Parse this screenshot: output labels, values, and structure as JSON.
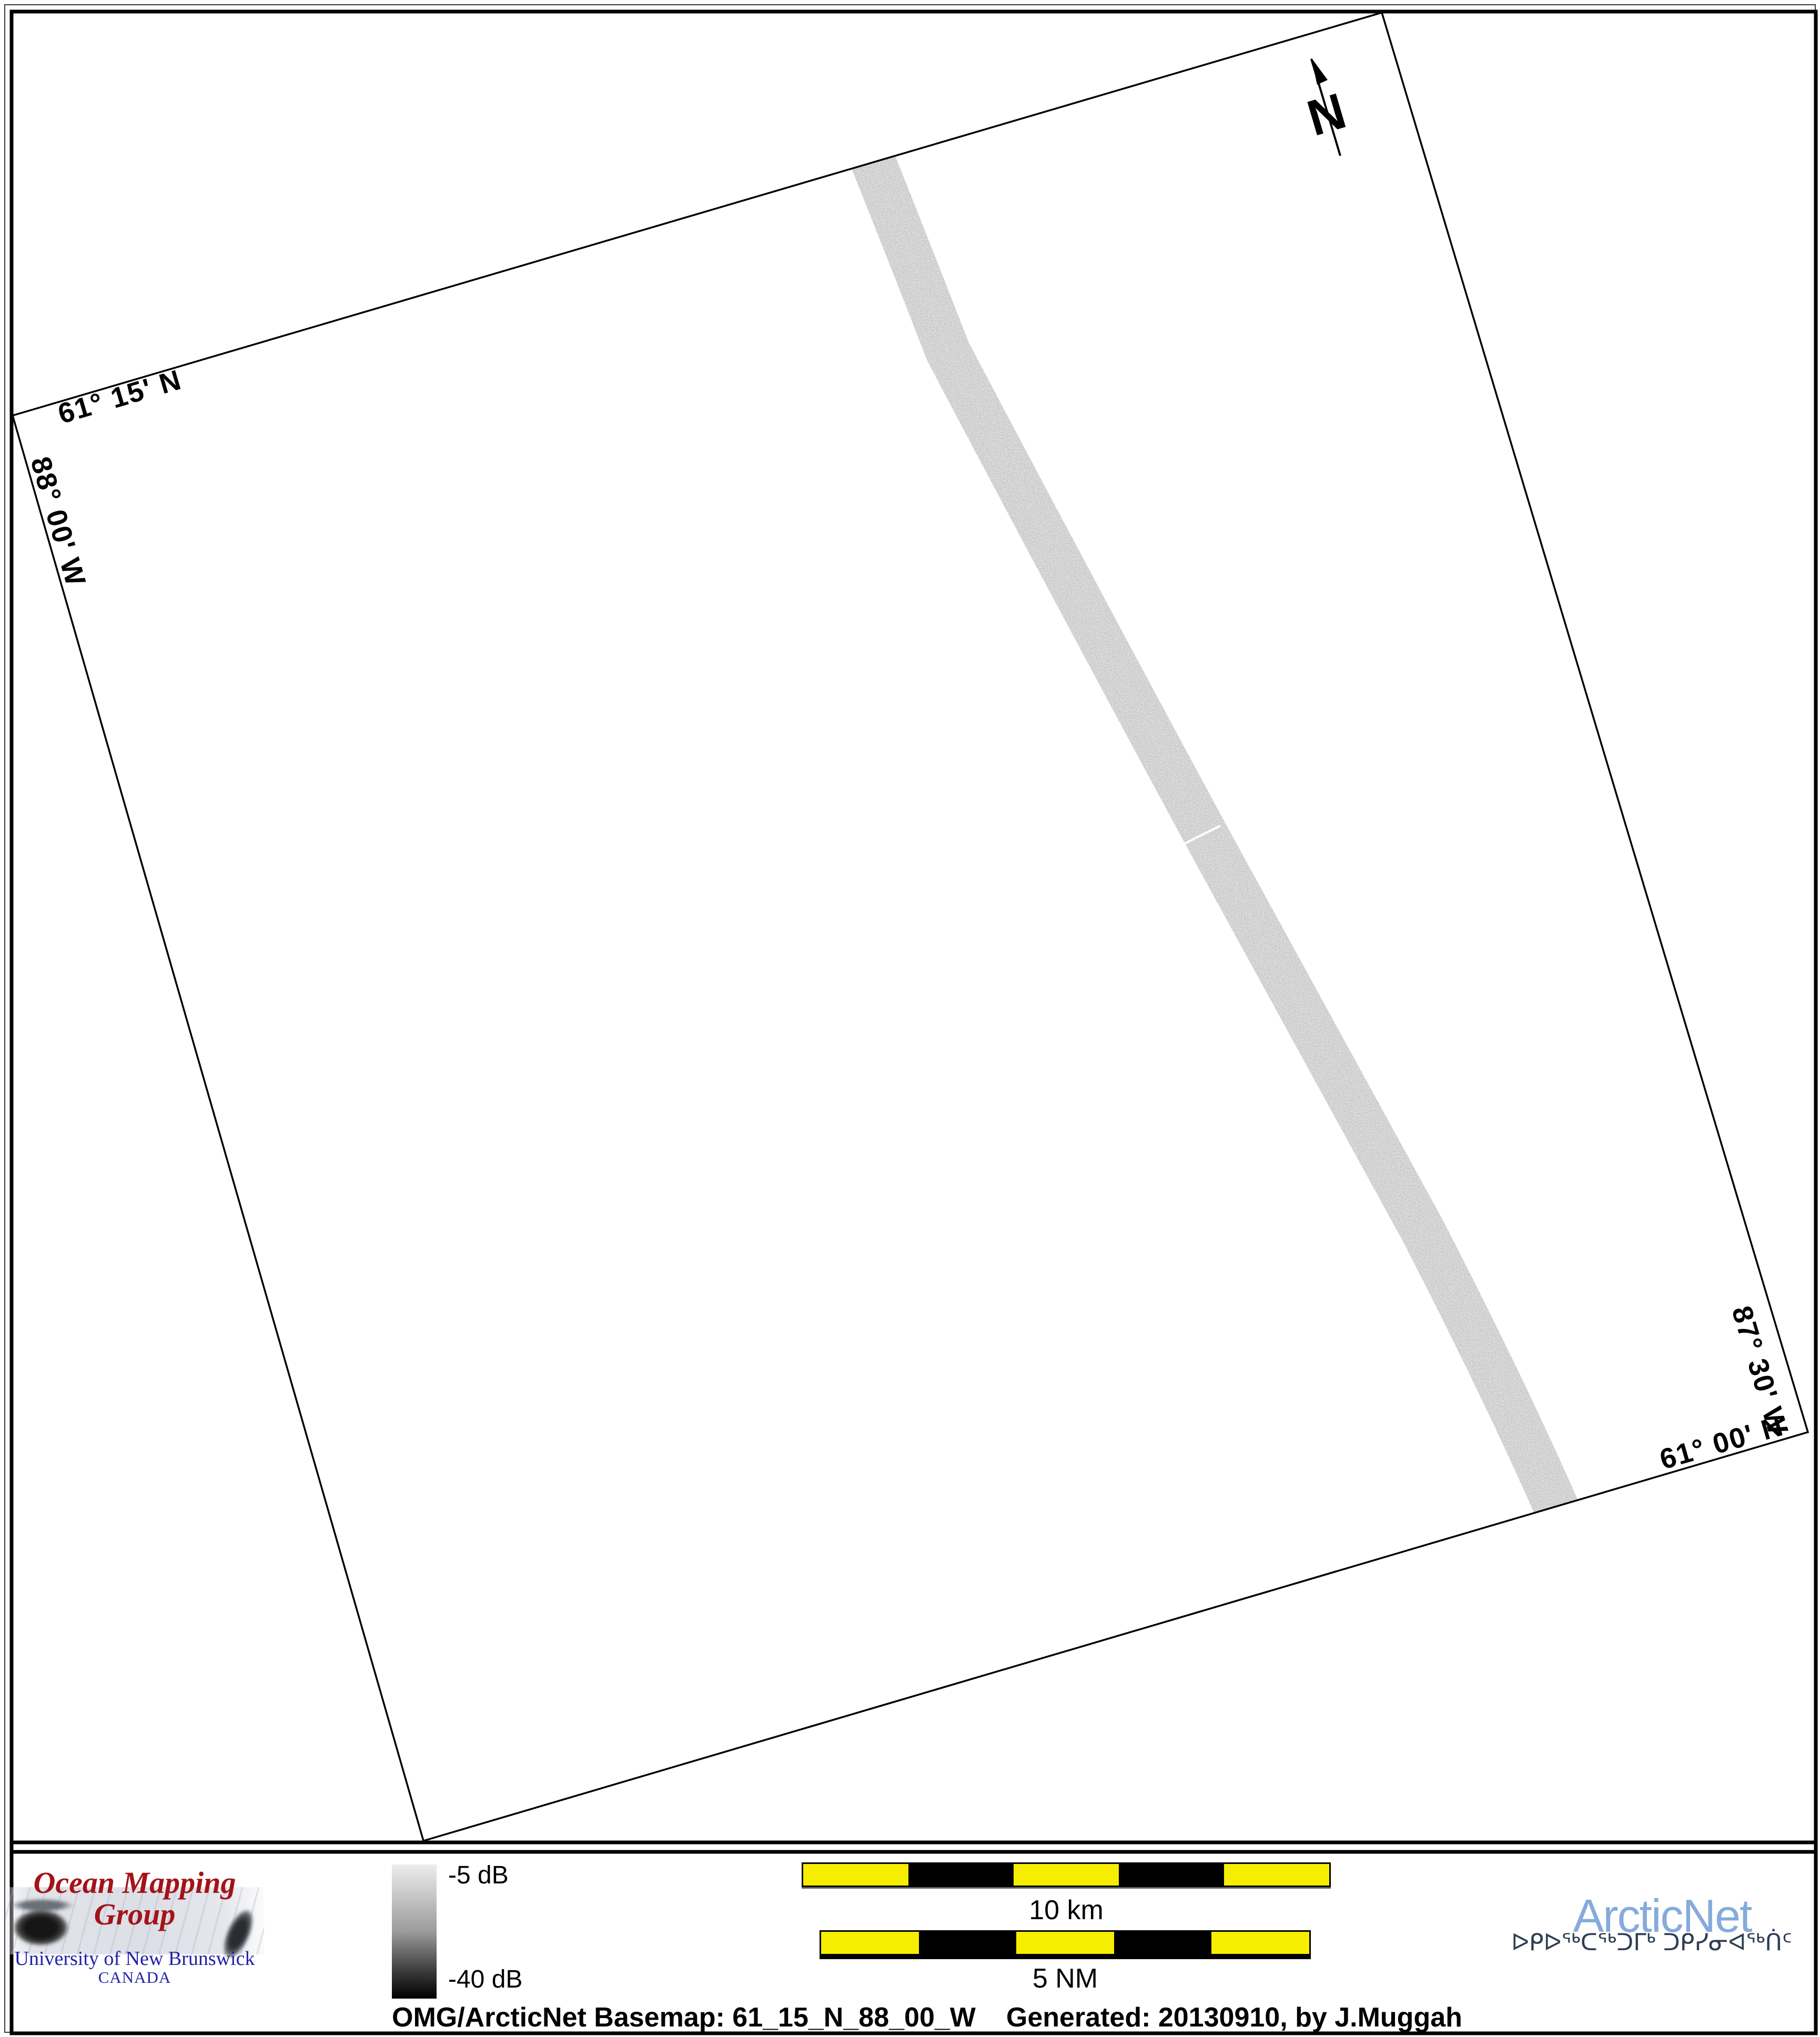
{
  "map": {
    "corner_labels": {
      "top_lat": "61° 15' N",
      "left_lon": "88° 00' W",
      "right_lon": "87° 30' W",
      "bottom_lat": "61° 00' N"
    },
    "north_label": "N"
  },
  "legend": {
    "top_label": "-5 dB",
    "bottom_label": "-40 dB"
  },
  "scale_bars": {
    "km": {
      "label": "10 km"
    },
    "nm": {
      "label": "5 NM"
    }
  },
  "caption": {
    "left": "OMG/ArcticNet Basemap: 61_15_N_88_00_W",
    "right": "Generated: 20130910, by J.Muggah"
  },
  "logos": {
    "omg": {
      "title": "Ocean Mapping Group",
      "subtitle": "University of New Brunswick",
      "country": "CANADA"
    },
    "arcticnet": {
      "name": "ArcticNet",
      "inuktitut": "ᐅᑭᐅᖅᑕᖅᑐᒥᒃ ᑐᑭᓯᓂᐊᖅᑏᑦ"
    }
  },
  "colors": {
    "scale_yellow": "#f5ee00",
    "omg_red": "#a31318",
    "unb_blue": "#2121a8",
    "arcticnet_blue": "#85abdb",
    "syllabics_navy": "#2e3e52",
    "swath_gray": "#a6a6a6",
    "legend_top": "#ededed",
    "legend_bottom": "#000000"
  }
}
